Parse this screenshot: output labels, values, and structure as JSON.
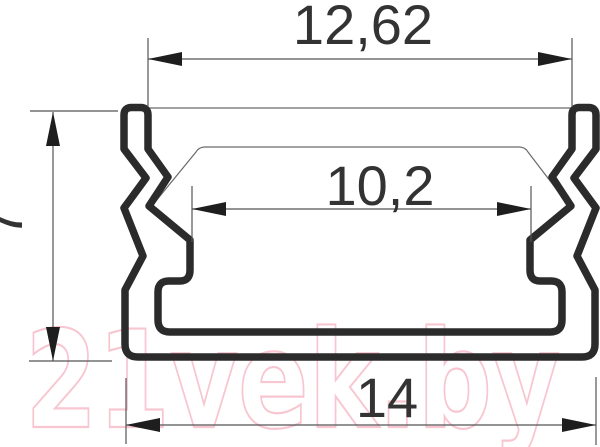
{
  "drawing": {
    "title": "profile-cross-section",
    "dimensions": {
      "top_width": "12,62",
      "inner_width": "10,2",
      "bottom_width": "14",
      "height": "7"
    },
    "colors": {
      "outline": "#2b2b2b",
      "thin_line": "#6a6a6a",
      "dimension_text": "#333333",
      "watermark": "#f7c6d0",
      "background": "#ffffff"
    }
  },
  "watermark": {
    "text": "21vek.by"
  }
}
